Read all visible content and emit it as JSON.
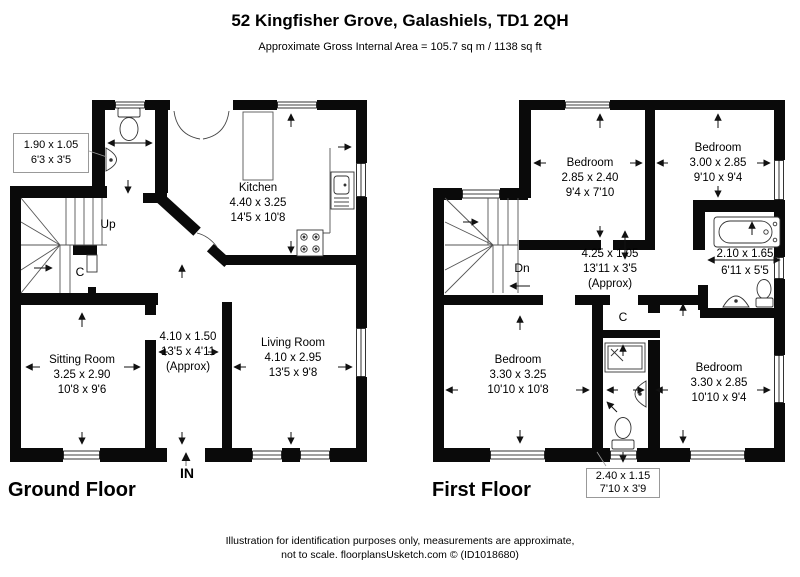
{
  "header": {
    "title": "52 Kingfisher Grove, Galashiels, TD1 2QH",
    "subtitle": "Approximate Gross Internal Area = 105.7 sq m / 1138 sq ft"
  },
  "ground_floor": {
    "label": "Ground Floor",
    "entrance": "IN",
    "stairs": "Up",
    "closet": "C",
    "rooms": {
      "wc": {
        "metric": "1.90 x 1.05",
        "imperial": "6'3 x 3'5"
      },
      "kitchen": {
        "name": "Kitchen",
        "metric": "4.40 x 3.25",
        "imperial": "14'5 x 10'8"
      },
      "sitting_room": {
        "name": "Sitting Room",
        "metric": "3.25 x 2.90",
        "imperial": "10'8 x 9'6"
      },
      "hall": {
        "metric": "4.10 x 1.50",
        "imperial": "13'5 x 4'11",
        "note": "(Approx)"
      },
      "living_room": {
        "name": "Living Room",
        "metric": "4.10 x 2.95",
        "imperial": "13'5 x 9'8"
      }
    }
  },
  "first_floor": {
    "label": "First Floor",
    "stairs": "Dn",
    "closet": "C",
    "rooms": {
      "bedroom_top_left": {
        "name": "Bedroom",
        "metric": "2.85 x 2.40",
        "imperial": "9'4 x 7'10"
      },
      "bedroom_top_right": {
        "name": "Bedroom",
        "metric": "3.00 x 2.85",
        "imperial": "9'10 x 9'4"
      },
      "bathroom": {
        "metric": "2.10 x 1.65",
        "imperial": "6'11 x 5'5"
      },
      "landing": {
        "metric": "4.25 x 1.05",
        "imperial": "13'11 x 3'5",
        "note": "(Approx)"
      },
      "bedroom_bottom_left": {
        "name": "Bedroom",
        "metric": "3.30 x 3.25",
        "imperial": "10'10 x 10'8"
      },
      "bedroom_bottom_right": {
        "name": "Bedroom",
        "metric": "3.30 x 2.85",
        "imperial": "10'10 x 9'4"
      },
      "shower_room": {
        "metric": "2.40 x 1.15",
        "imperial": "7'10 x 3'9"
      }
    }
  },
  "footer": {
    "line1": "Illustration for identification purposes only, measurements are approximate,",
    "line2": "not to scale. floorplansUsketch.com © (ID1018680)"
  }
}
